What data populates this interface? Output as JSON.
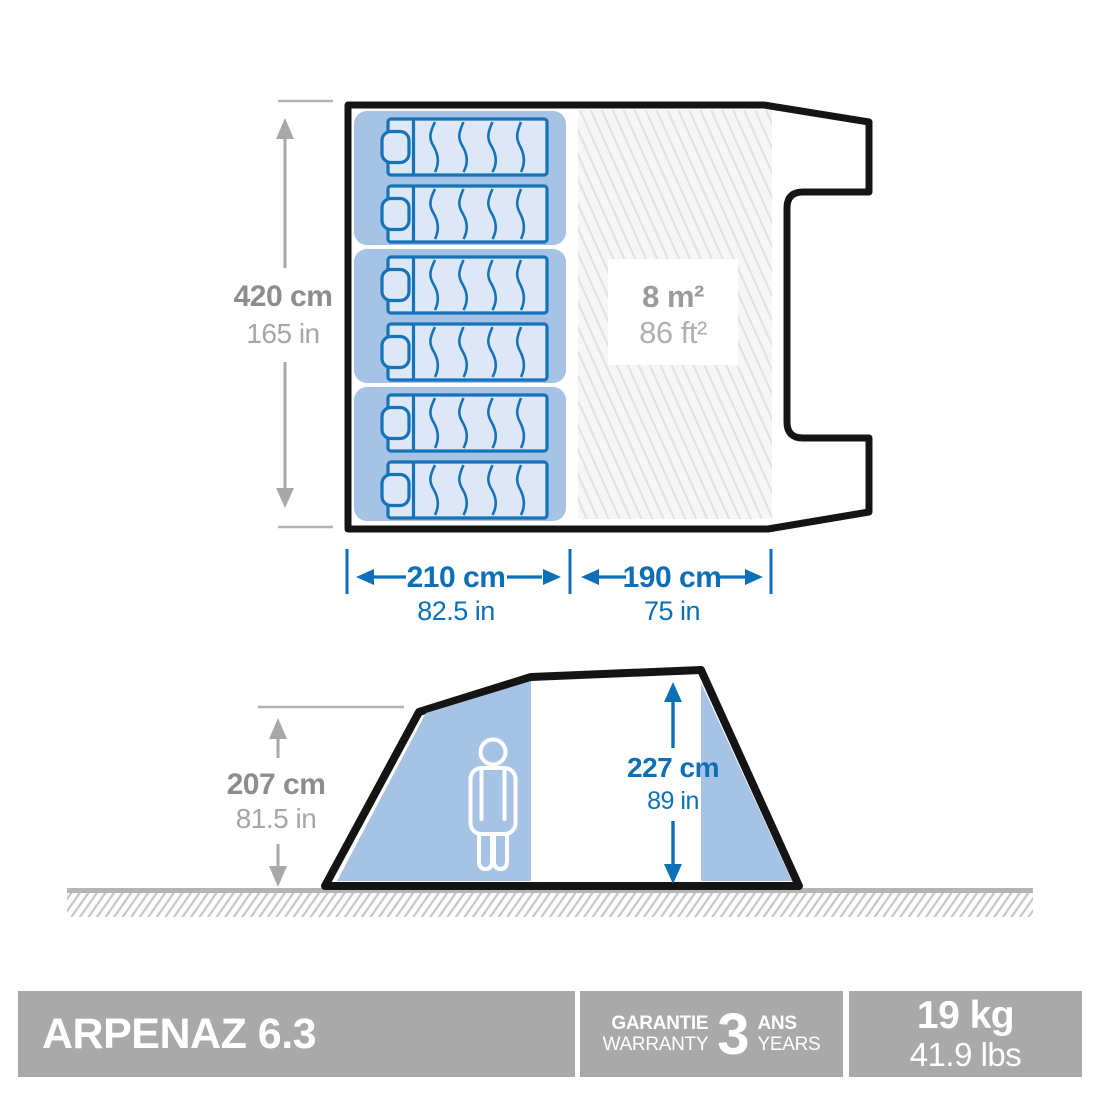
{
  "top_view": {
    "length_cm": "420 cm",
    "length_in": "165 in",
    "bedroom_cm": "210 cm",
    "bedroom_in": "82.5 in",
    "living_cm": "190 cm",
    "living_in": "75 in",
    "area_m2": "8 m²",
    "area_ft2": "86 ft²",
    "bed_count": 6
  },
  "side_view": {
    "exterior_cm": "207 cm",
    "exterior_in": "81.5 in",
    "interior_cm": "227 cm",
    "interior_in": "89 in"
  },
  "footer": {
    "product_name": "ARPENAZ 6.3",
    "warranty_fr": "GARANTIE",
    "warranty_en": "WARRANTY",
    "warranty_value": "3",
    "warranty_unit_fr": "ANS",
    "warranty_unit_en": "YEARS",
    "weight_kg": "19 kg",
    "weight_lbs": "41.9 lbs"
  },
  "colors": {
    "accent_blue": "#0d6fb5",
    "panel_blue": "#a6c2e4",
    "mat_fill": "#dde7f5",
    "outline_black": "#141414",
    "bar_gray": "#a9a9a9"
  }
}
